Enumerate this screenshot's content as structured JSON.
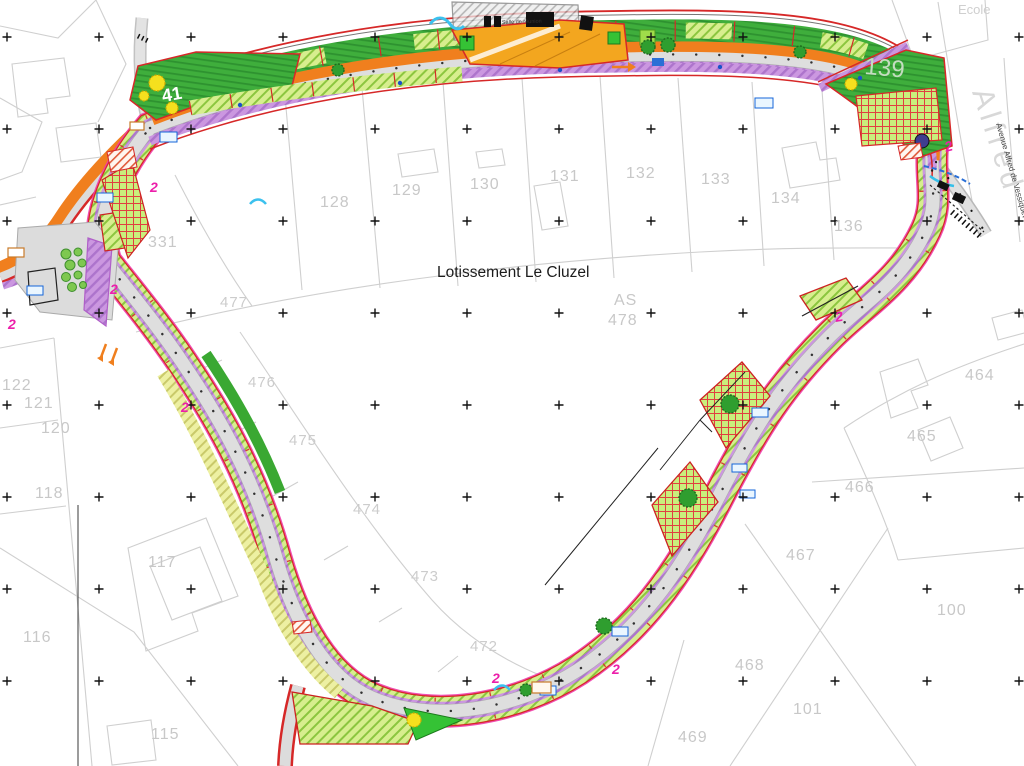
{
  "title": "Lotissement Le Cluzel",
  "corner_labels": {
    "school": "Ecole",
    "street_name_large": "Alfred",
    "street_name": "Avenue Alfred de Vessiquet"
  },
  "zones": {
    "lawn_left": "41",
    "lawn_right": "139",
    "building": "Salle de réunion",
    "central_section": "AS"
  },
  "marks": {
    "revision": "2"
  },
  "parcels": [
    {
      "n": "128"
    },
    {
      "n": "129"
    },
    {
      "n": "130"
    },
    {
      "n": "131"
    },
    {
      "n": "132"
    },
    {
      "n": "133"
    },
    {
      "n": "134"
    },
    {
      "n": "136"
    },
    {
      "n": "331"
    },
    {
      "n": "477"
    },
    {
      "n": "476"
    },
    {
      "n": "475"
    },
    {
      "n": "474"
    },
    {
      "n": "473"
    },
    {
      "n": "472"
    },
    {
      "n": "478"
    },
    {
      "n": "122"
    },
    {
      "n": "121"
    },
    {
      "n": "120"
    },
    {
      "n": "118"
    },
    {
      "n": "117"
    },
    {
      "n": "116"
    },
    {
      "n": "115"
    },
    {
      "n": "464"
    },
    {
      "n": "465"
    },
    {
      "n": "466"
    },
    {
      "n": "467"
    },
    {
      "n": "468"
    },
    {
      "n": "469"
    },
    {
      "n": "100"
    },
    {
      "n": "101"
    }
  ],
  "colors": {
    "road_orange": "#f07f1e",
    "sidewalk_purple": "#c993dd",
    "verge_green": "#d7ee8e",
    "lawn_green": "#3fae3c",
    "boundary_red": "#d62828",
    "revision_pink": "#ec1faa",
    "road_gray": "#dedede",
    "parcel_gray": "#cfcfcf"
  }
}
